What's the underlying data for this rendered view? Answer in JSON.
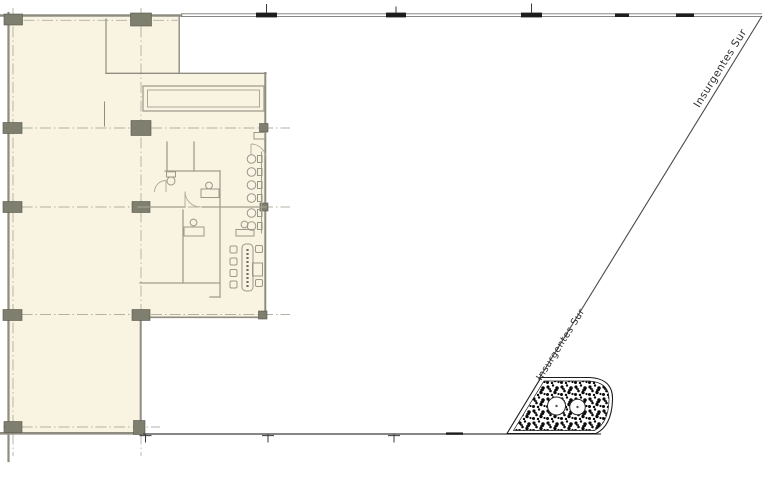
{
  "plan": {
    "street_labels": {
      "upper": "Insurgentes Sur",
      "lower": "Insurgentes Sur"
    },
    "colors": {
      "background": "#ffffff",
      "floor_fill": "#f9f3e1",
      "wall_line": "#8f8d81",
      "interior_wall_line": "#a29f91",
      "grid_centerline": "#b3b0a4",
      "column_fill": "#7f7f70",
      "site_boundary": "#767672",
      "street_line": "#4a4a4a",
      "boundary_marker": "#1d1d1d",
      "label_text": "#2f2f2f",
      "vegetation_ink": "#0b0b0b"
    }
  }
}
